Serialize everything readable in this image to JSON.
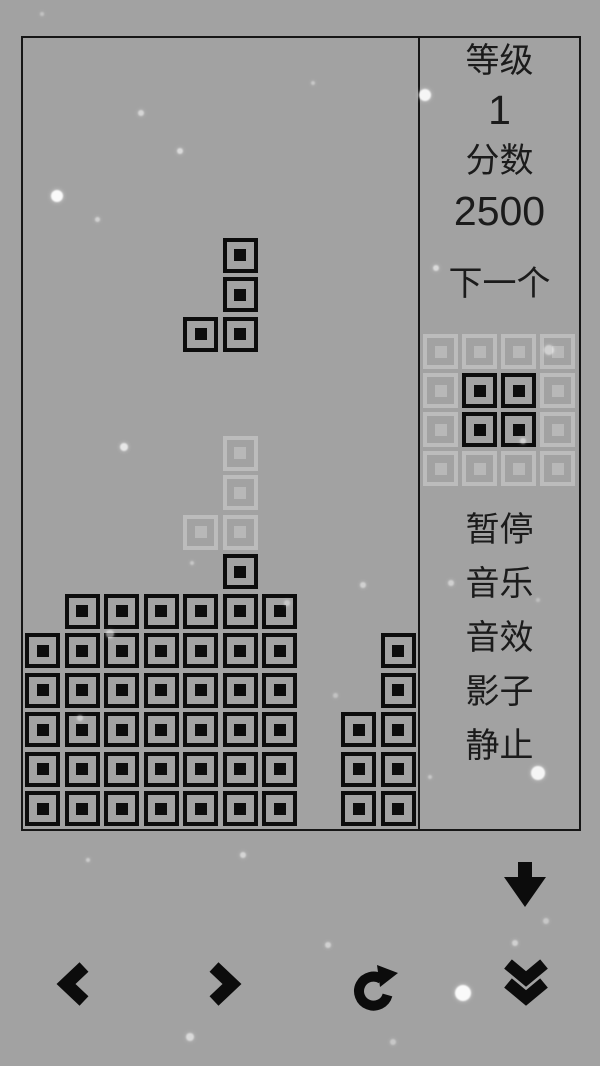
{
  "app": {
    "name": "tetris-game",
    "colors": {
      "background": "#a2a2a2",
      "block": "#0c0c0c",
      "ghost": "#bcbcbc",
      "text": "#1b1b1b"
    }
  },
  "sidebar": {
    "level_label": "等级",
    "level_value": "1",
    "score_label": "分数",
    "score_value": "2500",
    "next_label": "下一个",
    "menu": [
      {
        "id": "pause",
        "label": "暂停"
      },
      {
        "id": "music",
        "label": "音乐"
      },
      {
        "id": "sound",
        "label": "音效"
      },
      {
        "id": "shadow",
        "label": "影子"
      },
      {
        "id": "still",
        "label": "静止"
      }
    ]
  },
  "board": {
    "cols": 10,
    "rows": 20,
    "stack": [
      [
        13,
        5
      ],
      [
        14,
        1
      ],
      [
        14,
        2
      ],
      [
        14,
        3
      ],
      [
        14,
        4
      ],
      [
        14,
        5
      ],
      [
        14,
        6
      ],
      [
        15,
        0
      ],
      [
        15,
        1
      ],
      [
        15,
        2
      ],
      [
        15,
        3
      ],
      [
        15,
        4
      ],
      [
        15,
        5
      ],
      [
        15,
        6
      ],
      [
        15,
        9
      ],
      [
        16,
        0
      ],
      [
        16,
        1
      ],
      [
        16,
        2
      ],
      [
        16,
        3
      ],
      [
        16,
        4
      ],
      [
        16,
        5
      ],
      [
        16,
        6
      ],
      [
        16,
        9
      ],
      [
        17,
        0
      ],
      [
        17,
        1
      ],
      [
        17,
        2
      ],
      [
        17,
        3
      ],
      [
        17,
        4
      ],
      [
        17,
        5
      ],
      [
        17,
        6
      ],
      [
        17,
        8
      ],
      [
        17,
        9
      ],
      [
        18,
        0
      ],
      [
        18,
        1
      ],
      [
        18,
        2
      ],
      [
        18,
        3
      ],
      [
        18,
        4
      ],
      [
        18,
        5
      ],
      [
        18,
        6
      ],
      [
        18,
        8
      ],
      [
        18,
        9
      ],
      [
        19,
        0
      ],
      [
        19,
        1
      ],
      [
        19,
        2
      ],
      [
        19,
        3
      ],
      [
        19,
        4
      ],
      [
        19,
        5
      ],
      [
        19,
        6
      ],
      [
        19,
        8
      ],
      [
        19,
        9
      ]
    ],
    "falling_piece": {
      "type": "J",
      "cells": [
        [
          5,
          5
        ],
        [
          6,
          5
        ],
        [
          7,
          5
        ],
        [
          7,
          4
        ]
      ]
    },
    "ghost_piece": {
      "cells": [
        [
          10,
          5
        ],
        [
          11,
          5
        ],
        [
          12,
          5
        ],
        [
          12,
          4
        ]
      ]
    }
  },
  "next_preview": {
    "grid_size": 4,
    "piece_type": "O",
    "filled_cells": [
      [
        1,
        1
      ],
      [
        1,
        2
      ],
      [
        2,
        1
      ],
      [
        2,
        2
      ]
    ]
  },
  "controls": [
    {
      "id": "soft-drop",
      "icon": "down-arrow-icon"
    },
    {
      "id": "move-left",
      "icon": "chevron-left-icon"
    },
    {
      "id": "move-right",
      "icon": "chevron-right-icon"
    },
    {
      "id": "rotate",
      "icon": "rotate-clockwise-icon"
    },
    {
      "id": "hard-drop",
      "icon": "double-chevron-down-icon"
    }
  ],
  "speckles": [
    [
      57,
      196,
      6,
      0.95
    ],
    [
      141,
      113,
      3,
      0.55
    ],
    [
      180,
      151,
      3,
      0.6
    ],
    [
      97,
      219,
      2.5,
      0.5
    ],
    [
      313,
      83,
      2,
      0.4
    ],
    [
      425,
      95,
      6,
      0.9
    ],
    [
      436,
      268,
      3,
      0.6
    ],
    [
      523,
      441,
      3,
      0.5
    ],
    [
      124,
      447,
      4,
      0.75
    ],
    [
      192,
      563,
      2,
      0.4
    ],
    [
      363,
      585,
      3,
      0.5
    ],
    [
      335,
      695,
      2.5,
      0.35
    ],
    [
      549,
      350,
      5,
      0.5
    ],
    [
      451,
      583,
      3,
      0.5
    ],
    [
      538,
      773,
      7,
      0.9
    ],
    [
      430,
      777,
      2,
      0.4
    ],
    [
      88,
      860,
      2,
      0.45
    ],
    [
      243,
      855,
      3,
      0.55
    ],
    [
      328,
      945,
      3,
      0.5
    ],
    [
      463,
      993,
      8,
      0.95
    ],
    [
      515,
      943,
      3,
      0.5
    ],
    [
      190,
      1037,
      4,
      0.6
    ],
    [
      393,
      1042,
      3,
      0.4
    ],
    [
      110,
      634,
      4,
      0.5
    ],
    [
      80,
      718,
      3,
      0.45
    ],
    [
      42,
      14,
      2,
      0.35
    ],
    [
      287,
      603,
      3,
      0.4
    ],
    [
      538,
      600,
      2,
      0.3
    ],
    [
      546,
      921,
      3,
      0.4
    ]
  ]
}
